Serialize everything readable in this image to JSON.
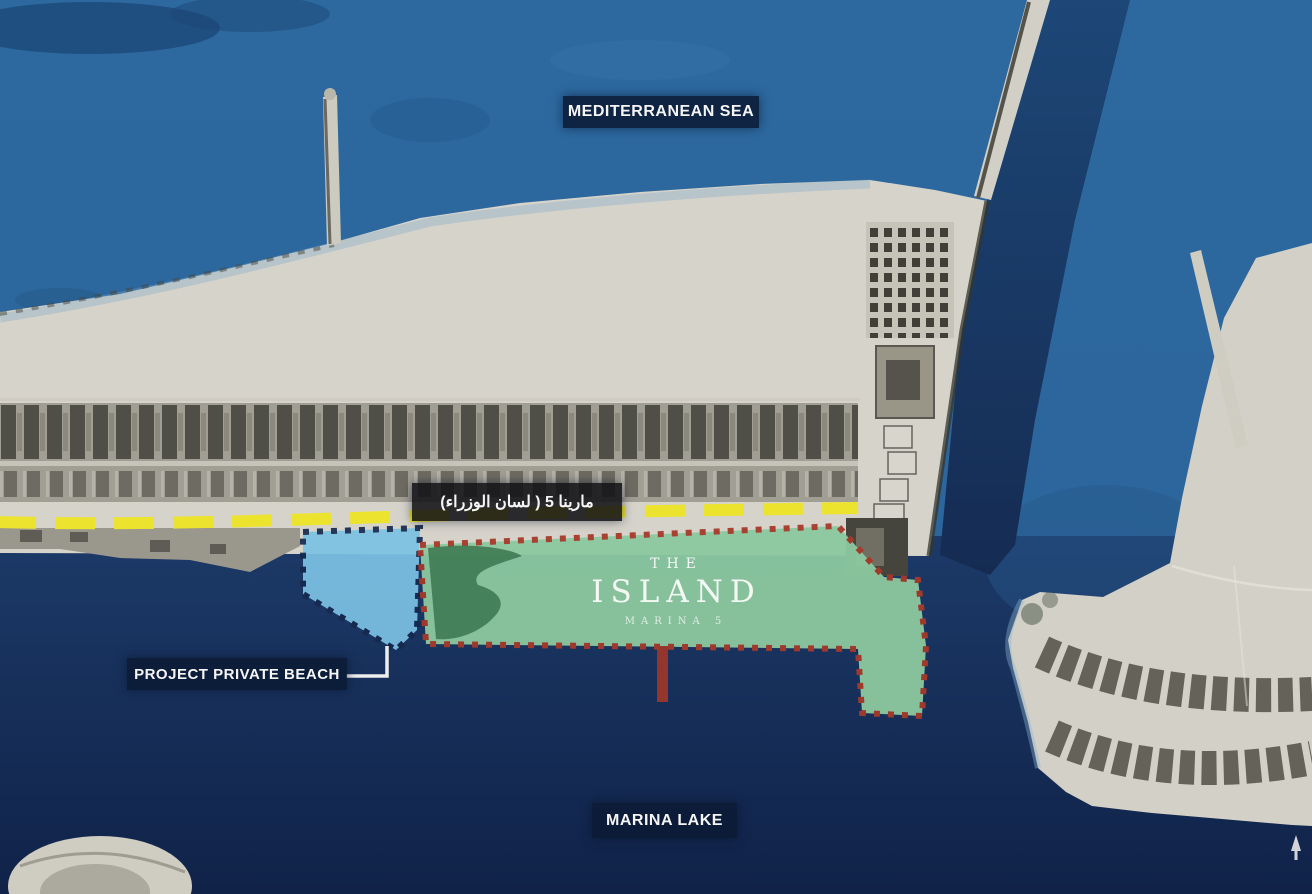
{
  "map": {
    "title": "Satellite master plan of The Island Marina 5 project",
    "labels": {
      "sea": "MEDITERRANEAN SEA",
      "lake": "MARINA LAKE",
      "beach_callout": "PROJECT PRIVATE BEACH",
      "road_arabic": "مارينا 5 ( لسان الوزراء)",
      "project_the": "THE",
      "project_name": "ISLAND",
      "project_sub": "MARINA 5"
    },
    "colors": {
      "sea": "#2e6ba2",
      "sea_deep": "#1b4676",
      "channel": "#1d4777",
      "lake": "#14294e",
      "sand": "#d6d3cb",
      "road_yellow": "#ece32e",
      "green_overlay": "#8cc9a0",
      "green_border": "#a63a2a",
      "green_patch": "#35704a",
      "blue_overlay": "#7cc2e4",
      "blue_border": "#16294e",
      "pier_red": "#9c372b",
      "label_bg": "#0b1a35",
      "label_text": "#f5f5f5"
    }
  }
}
